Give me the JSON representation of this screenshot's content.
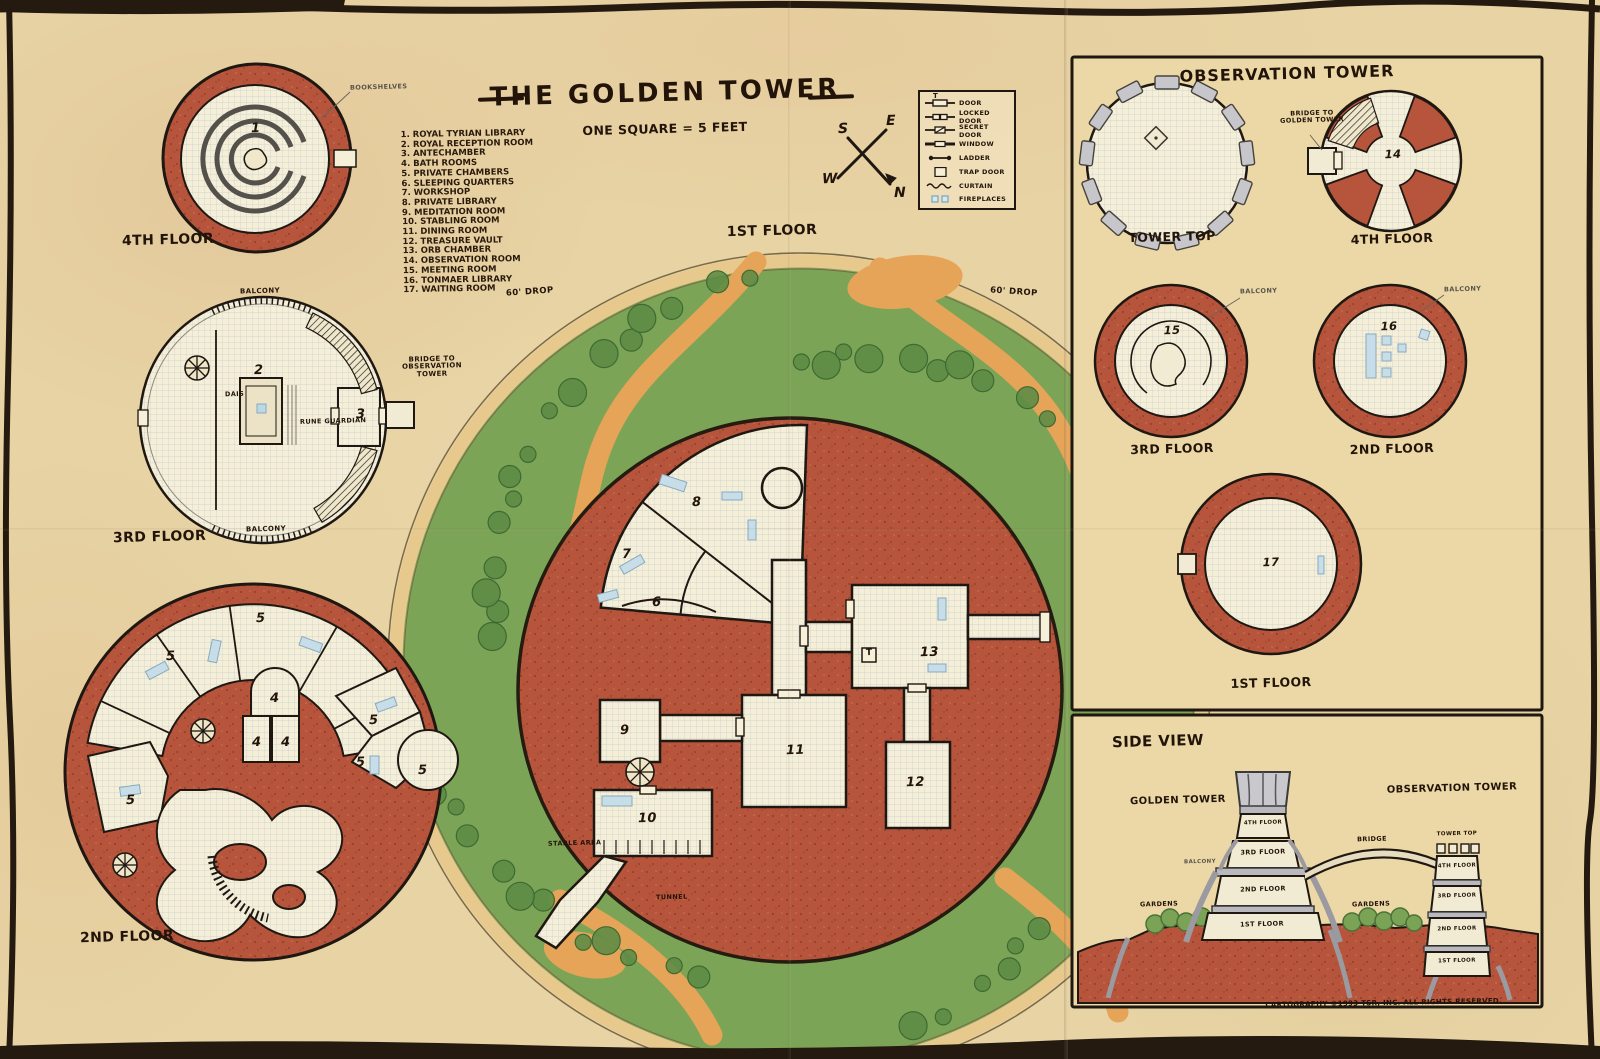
{
  "map": {
    "title": "THE GOLDEN TOWER",
    "scale_note": "ONE SQUARE = 5 FEET",
    "copyright": "CARTOGRAPHY ©1993 TSR, INC. ALL RIGHTS RESERVED."
  },
  "room_index": {
    "items": [
      "1. ROYAL TYRIAN LIBRARY",
      "2. ROYAL RECEPTION ROOM",
      "3. ANTECHAMBER",
      "4. BATH ROOMS",
      "5. PRIVATE CHAMBERS",
      "6. SLEEPING QUARTERS",
      "7. WORKSHOP",
      "8. PRIVATE LIBRARY",
      "9. MEDITATION ROOM",
      "10. STABLING ROOM",
      "11. DINING ROOM",
      "12. TREASURE VAULT",
      "13. ORB CHAMBER",
      "14. OBSERVATION ROOM",
      "15. MEETING ROOM",
      "16. TONMAER LIBRARY",
      "17. WAITING ROOM"
    ]
  },
  "key": {
    "items": [
      "DOOR",
      "LOCKED DOOR",
      "SECRET DOOR",
      "WINDOW",
      "LADDER",
      "TRAP DOOR",
      "CURTAIN",
      "FIREPLACES"
    ],
    "trap_symbol": "T"
  },
  "compass": {
    "n": "N",
    "e": "E",
    "s": "S",
    "w": "W"
  },
  "floor_labels": {
    "f1": "1ST FLOOR",
    "f2": "2ND FLOOR",
    "f3": "3RD FLOOR",
    "f4": "4TH FLOOR",
    "tower_top": "TOWER TOP"
  },
  "common": {
    "balcony": "BALCONY"
  },
  "golden_tower": {
    "bridge_note": "BRIDGE TO OBSERVATION TOWER",
    "dais_note": "DAIS",
    "guardian_note": "RUNE GUARDIAN",
    "bookshelves_note": "BOOKSHELVES",
    "drop_note": "60' DROP",
    "stable_note": "STABLE AREA",
    "tunnel_note": "TUNNEL"
  },
  "observation_tower": {
    "title": "OBSERVATION TOWER",
    "bridge_note": "BRIDGE TO GOLDEN TOWER"
  },
  "side_view": {
    "title": "SIDE VIEW",
    "golden_tower_label": "GOLDEN TOWER",
    "observation_tower_label": "OBSERVATION TOWER",
    "bridge_label": "BRIDGE",
    "gardens_label": "GARDENS"
  },
  "plan_numbers": {
    "n1": "1",
    "n2": "2",
    "n3": "3",
    "n4": "4",
    "n5": "5",
    "n6": "6",
    "n7": "7",
    "n8": "8",
    "n9": "9",
    "n10": "10",
    "n11": "11",
    "n12": "12",
    "n13": "13",
    "n14": "14",
    "n15": "15",
    "n16": "16",
    "n17": "17"
  }
}
